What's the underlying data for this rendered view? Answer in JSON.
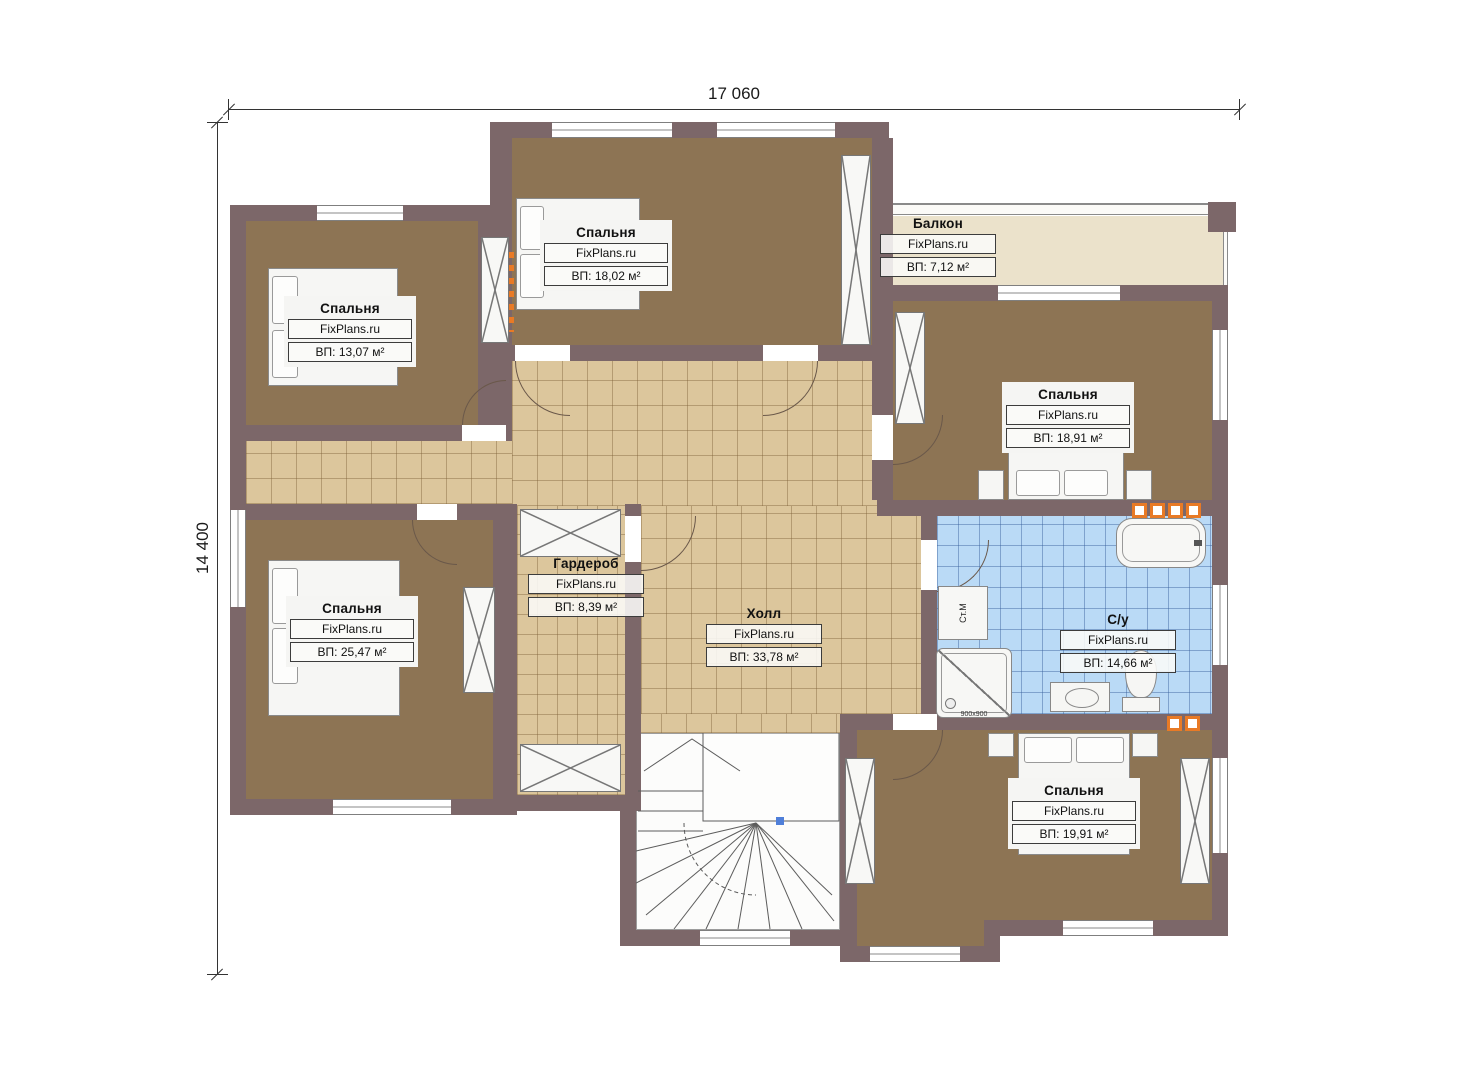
{
  "dimensions": {
    "width_label": "17 060",
    "height_label": "14 400"
  },
  "rooms": [
    {
      "key": "bedroom_top_left",
      "name": "Спальня",
      "brand": "FixPlans.ru",
      "area": "ВП: 13,07 м²"
    },
    {
      "key": "bedroom_top_center",
      "name": "Спальня",
      "brand": "FixPlans.ru",
      "area": "ВП: 18,02 м²"
    },
    {
      "key": "balcony",
      "name": "Балкон",
      "brand": "FixPlans.ru",
      "area": "ВП: 7,12 м²"
    },
    {
      "key": "bedroom_right",
      "name": "Спальня",
      "brand": "FixPlans.ru",
      "area": "ВП: 18,91 м²"
    },
    {
      "key": "bedroom_bottom_left",
      "name": "Спальня",
      "brand": "FixPlans.ru",
      "area": "ВП: 25,47 м²"
    },
    {
      "key": "wardrobe",
      "name": "Гардероб",
      "brand": "FixPlans.ru",
      "area": "ВП: 8,39 м²"
    },
    {
      "key": "hall",
      "name": "Холл",
      "brand": "FixPlans.ru",
      "area": "ВП: 33,78 м²"
    },
    {
      "key": "bathroom",
      "name": "С/у",
      "brand": "FixPlans.ru",
      "area": "ВП: 14,66 м²"
    },
    {
      "key": "bedroom_bottom_right",
      "name": "Спальня",
      "brand": "FixPlans.ru",
      "area": "ВП: 19,91 м²"
    }
  ],
  "fixtures": {
    "washing_machine_label": "Ст.М",
    "shower_dimensions": "900x900"
  },
  "colors": {
    "wall": "#7c6769",
    "bedroom_floor": "#8d7454",
    "hall_floor": "#dcc69c",
    "bathroom_floor": "#badaf6",
    "balcony_floor": "#ebe2cb",
    "radiator_accent": "#e87a26"
  }
}
